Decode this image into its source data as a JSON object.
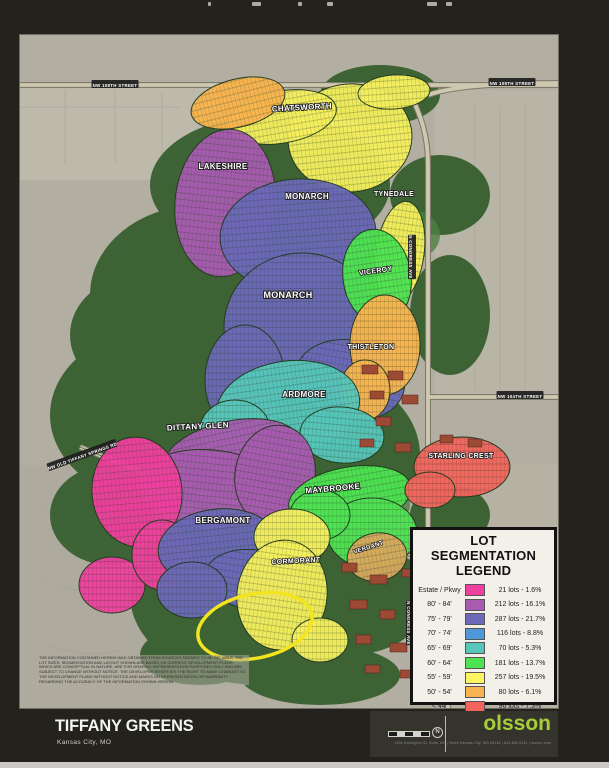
{
  "header": {
    "top_fragments": [
      {
        "x": 208,
        "w": 3
      },
      {
        "x": 252,
        "w": 9
      },
      {
        "x": 298,
        "w": 4
      },
      {
        "x": 327,
        "w": 6
      },
      {
        "x": 427,
        "w": 10
      },
      {
        "x": 446,
        "w": 6
      }
    ]
  },
  "legend": {
    "title_line1": "LOT SEGMENTATION",
    "title_line2": "LEGEND",
    "rows": [
      {
        "label": "Estate / Pkwy",
        "color": "#f0409f",
        "value": "21 lots - 1.6%"
      },
      {
        "label": "80' - 84'",
        "color": "#a85cb0",
        "value": "212 lots - 16.1%"
      },
      {
        "label": "75' - 79'",
        "color": "#6b69b8",
        "value": "287 lots - 21.7%"
      },
      {
        "label": "70' - 74'",
        "color": "#4e97d8",
        "value": "116 lots - 8.8%"
      },
      {
        "label": "65' - 69'",
        "color": "#57c6bb",
        "value": "70 lots - 5.3%"
      },
      {
        "label": "60' - 64'",
        "color": "#4ee352",
        "value": "181 lots - 13.7%"
      },
      {
        "label": "55' - 59'",
        "color": "#fbf463",
        "value": "257 lots - 19.5%"
      },
      {
        "label": "50' - 54'",
        "color": "#f8b44e",
        "value": "80 lots - 6.1%"
      },
      {
        "label": "< 44'",
        "color": "#f4645c",
        "value": "96 lots - 7.3%"
      }
    ]
  },
  "map": {
    "neighborhoods": [
      {
        "id": "chatsworth",
        "color": "#f5ef5e",
        "shapes": [
          {
            "cx": 330,
            "cy": 103,
            "rx": 62,
            "ry": 54,
            "rot": -6
          },
          {
            "cx": 262,
            "cy": 82,
            "rx": 55,
            "ry": 26,
            "rot": -10
          },
          {
            "cx": 374,
            "cy": 57,
            "rx": 36,
            "ry": 17,
            "rot": -4
          }
        ]
      },
      {
        "id": "chatsworth-west",
        "color": "#f8b44e",
        "shapes": [
          {
            "cx": 218,
            "cy": 68,
            "rx": 48,
            "ry": 24,
            "rot": -14
          }
        ]
      },
      {
        "id": "lakeshire",
        "color": "#a85cb0",
        "shapes": [
          {
            "cx": 205,
            "cy": 168,
            "rx": 50,
            "ry": 74,
            "rot": 6
          }
        ]
      },
      {
        "id": "monarch",
        "color": "#6b69b8",
        "shapes": [
          {
            "cx": 278,
            "cy": 200,
            "rx": 78,
            "ry": 56,
            "rot": -4
          },
          {
            "cx": 282,
            "cy": 292,
            "rx": 78,
            "ry": 74,
            "rot": 0
          },
          {
            "cx": 330,
            "cy": 345,
            "rx": 55,
            "ry": 40,
            "rot": 10
          },
          {
            "cx": 225,
            "cy": 345,
            "rx": 40,
            "ry": 55,
            "rot": 0
          }
        ]
      },
      {
        "id": "tynedale",
        "color": "#f5ef5e",
        "shapes": [
          {
            "cx": 380,
            "cy": 218,
            "rx": 24,
            "ry": 52,
            "rot": 8
          }
        ]
      },
      {
        "id": "viceroy",
        "color": "#4ee352",
        "shapes": [
          {
            "cx": 357,
            "cy": 242,
            "rx": 34,
            "ry": 48,
            "rot": -8
          }
        ]
      },
      {
        "id": "thistleton",
        "color": "#f8b44e",
        "shapes": [
          {
            "cx": 365,
            "cy": 310,
            "rx": 35,
            "ry": 50,
            "rot": 0
          },
          {
            "cx": 345,
            "cy": 355,
            "rx": 25,
            "ry": 30,
            "rot": 0
          }
        ]
      },
      {
        "id": "ardmore",
        "color": "#57c6bb",
        "shapes": [
          {
            "cx": 268,
            "cy": 372,
            "rx": 72,
            "ry": 46,
            "rot": -8
          },
          {
            "cx": 322,
            "cy": 400,
            "rx": 42,
            "ry": 28,
            "rot": 5
          },
          {
            "cx": 215,
            "cy": 395,
            "rx": 35,
            "ry": 30,
            "rot": 0
          }
        ]
      },
      {
        "id": "dittany-glen",
        "color": "#a85cb0",
        "shapes": [
          {
            "cx": 212,
            "cy": 420,
            "rx": 70,
            "ry": 34,
            "rot": -12
          },
          {
            "cx": 192,
            "cy": 455,
            "rx": 75,
            "ry": 40,
            "rot": 6
          },
          {
            "cx": 255,
            "cy": 440,
            "rx": 40,
            "ry": 50,
            "rot": 10
          }
        ]
      },
      {
        "id": "estate-west",
        "color": "#f0409f",
        "shapes": [
          {
            "cx": 117,
            "cy": 457,
            "rx": 45,
            "ry": 55,
            "rot": -5
          },
          {
            "cx": 92,
            "cy": 550,
            "rx": 33,
            "ry": 28,
            "rot": 0
          },
          {
            "cx": 142,
            "cy": 520,
            "rx": 30,
            "ry": 35,
            "rot": 0
          }
        ]
      },
      {
        "id": "bergamont",
        "color": "#6b69b8",
        "shapes": [
          {
            "cx": 198,
            "cy": 512,
            "rx": 60,
            "ry": 38,
            "rot": -6
          },
          {
            "cx": 235,
            "cy": 545,
            "rx": 50,
            "ry": 30,
            "rot": 8
          },
          {
            "cx": 172,
            "cy": 555,
            "rx": 35,
            "ry": 28,
            "rot": 0
          }
        ]
      },
      {
        "id": "maybrooke",
        "color": "#4ee352",
        "shapes": [
          {
            "cx": 330,
            "cy": 462,
            "rx": 62,
            "ry": 30,
            "rot": -10
          },
          {
            "cx": 352,
            "cy": 498,
            "rx": 45,
            "ry": 35,
            "rot": 0
          },
          {
            "cx": 300,
            "cy": 480,
            "rx": 30,
            "ry": 25,
            "rot": 0
          }
        ]
      },
      {
        "id": "verdant",
        "color": "#d8a95e",
        "shapes": [
          {
            "cx": 357,
            "cy": 522,
            "rx": 30,
            "ry": 24,
            "rot": -10
          }
        ]
      },
      {
        "id": "cormorant",
        "color": "#f5ef5e",
        "shapes": [
          {
            "cx": 272,
            "cy": 502,
            "rx": 38,
            "ry": 28,
            "rot": 0
          },
          {
            "cx": 262,
            "cy": 560,
            "rx": 45,
            "ry": 55,
            "rot": 8
          },
          {
            "cx": 300,
            "cy": 605,
            "rx": 28,
            "ry": 22,
            "rot": 0
          }
        ]
      },
      {
        "id": "starling-crest",
        "color": "#f4645c",
        "shapes": [
          {
            "cx": 442,
            "cy": 432,
            "rx": 48,
            "ry": 30,
            "rot": 0
          },
          {
            "cx": 410,
            "cy": 455,
            "rx": 25,
            "ry": 18,
            "rot": 0
          }
        ]
      }
    ],
    "labels": [
      {
        "text": "CHATSWORTH",
        "x": 282,
        "y": 75,
        "size": 8,
        "rot": -3
      },
      {
        "text": "LAKESHIRE",
        "x": 203,
        "y": 134,
        "size": 8,
        "rot": 0
      },
      {
        "text": "MONARCH",
        "x": 287,
        "y": 164,
        "size": 8,
        "rot": 0
      },
      {
        "text": "MONARCH",
        "x": 268,
        "y": 263,
        "size": 9,
        "rot": 0
      },
      {
        "text": "TYNEDALE",
        "x": 374,
        "y": 161,
        "size": 7,
        "rot": 0
      },
      {
        "text": "VICEROY",
        "x": 356,
        "y": 238,
        "size": 7,
        "rot": -8
      },
      {
        "text": "THISTLETON",
        "x": 351,
        "y": 314,
        "size": 7,
        "rot": 0
      },
      {
        "text": "ARDMORE",
        "x": 284,
        "y": 362,
        "size": 8,
        "rot": 0
      },
      {
        "text": "DITTANY GLEN",
        "x": 178,
        "y": 394,
        "size": 8,
        "rot": -3
      },
      {
        "text": "BERGAMONT",
        "x": 203,
        "y": 488,
        "size": 8,
        "rot": 0
      },
      {
        "text": "MAYBROOKE",
        "x": 313,
        "y": 456,
        "size": 8,
        "rot": -5
      },
      {
        "text": "VERDANT",
        "x": 349,
        "y": 514,
        "size": 6,
        "rot": -18
      },
      {
        "text": "CORMORANT",
        "x": 276,
        "y": 528,
        "size": 7,
        "rot": -3
      },
      {
        "text": "STARLING CREST",
        "x": 441,
        "y": 423,
        "size": 7,
        "rot": 0
      }
    ],
    "blocks": {
      "color": "#9c4a34",
      "rects": [
        {
          "x": 342,
          "y": 330,
          "w": 16,
          "h": 9
        },
        {
          "x": 368,
          "y": 336,
          "w": 15,
          "h": 9
        },
        {
          "x": 350,
          "y": 356,
          "w": 14,
          "h": 8
        },
        {
          "x": 382,
          "y": 360,
          "w": 16,
          "h": 9
        },
        {
          "x": 356,
          "y": 382,
          "w": 15,
          "h": 9
        },
        {
          "x": 340,
          "y": 404,
          "w": 14,
          "h": 8
        },
        {
          "x": 375,
          "y": 408,
          "w": 16,
          "h": 9
        },
        {
          "x": 420,
          "y": 400,
          "w": 13,
          "h": 8
        },
        {
          "x": 448,
          "y": 404,
          "w": 14,
          "h": 8
        },
        {
          "x": 322,
          "y": 528,
          "w": 15,
          "h": 9
        },
        {
          "x": 350,
          "y": 540,
          "w": 17,
          "h": 9
        },
        {
          "x": 382,
          "y": 534,
          "w": 13,
          "h": 8
        },
        {
          "x": 330,
          "y": 565,
          "w": 17,
          "h": 9
        },
        {
          "x": 360,
          "y": 575,
          "w": 15,
          "h": 9
        },
        {
          "x": 392,
          "y": 570,
          "w": 13,
          "h": 8
        },
        {
          "x": 336,
          "y": 600,
          "w": 15,
          "h": 9
        },
        {
          "x": 370,
          "y": 608,
          "w": 17,
          "h": 9
        },
        {
          "x": 402,
          "y": 600,
          "w": 13,
          "h": 8
        },
        {
          "x": 345,
          "y": 630,
          "w": 15,
          "h": 8
        },
        {
          "x": 380,
          "y": 635,
          "w": 15,
          "h": 8
        }
      ]
    },
    "street_signs": [
      {
        "text": "NW 108TH STREET",
        "x": 95,
        "y": 49,
        "rot": 0
      },
      {
        "text": "NW 108TH STREET",
        "x": 492,
        "y": 47,
        "rot": 0
      },
      {
        "text": "NW 104TH STREET",
        "x": 500,
        "y": 360,
        "rot": 0
      },
      {
        "text": "N CONGRESS AVE",
        "x": 392,
        "y": 222,
        "rot": 90
      },
      {
        "text": "N CONGRESS AVE",
        "x": 390,
        "y": 588,
        "rot": 90
      },
      {
        "text": "NW OLD TIFFANY SPRINGS RD",
        "x": 62,
        "y": 420,
        "rot": -20
      }
    ],
    "highlight": {
      "cx": 235,
      "cy": 591,
      "rx": 58,
      "ry": 32,
      "rot": -12,
      "color": "#f2e41f",
      "width": 3.5
    },
    "disclaimer": "THE INFORMATION CONTAINED HEREIN WAS OBTAINED FROM SOURCES DEEMED TO BE RELIABLE. THE LOT SIZES, SEGMENTATION AND LAYOUT SHOWN ARE BASED ON CURRENT DEVELOPMENT PLANS, WHICH ARE CONCEPTUAL IN NATURE, ARE FOR GRAPHIC REPRESENTATION PURPOSES ONLY AND ARE SUBJECT TO CHANGE WITHOUT NOTICE. THE DEVELOPER RESERVES THE RIGHT TO MAKE CHANGES TO THE DEVELOPMENT PLANS WITHOUT NOTICE AND MAKES NO REPRESENTATION OR WARRANTY REGARDING THE ACCURACY OF THE INFORMATION SHOWN HEREIN."
  },
  "footer": {
    "title": "TIFFANY GREENS",
    "subtitle": "Kansas City, MO",
    "logo_text": "olsson",
    "logo_color": "#a6ce39",
    "address": "1301 Burlington St, Suite 100  |  North Kansas City, MO 64116  |  816.842.0141  |  olsson.com",
    "compass_letter": "N"
  }
}
